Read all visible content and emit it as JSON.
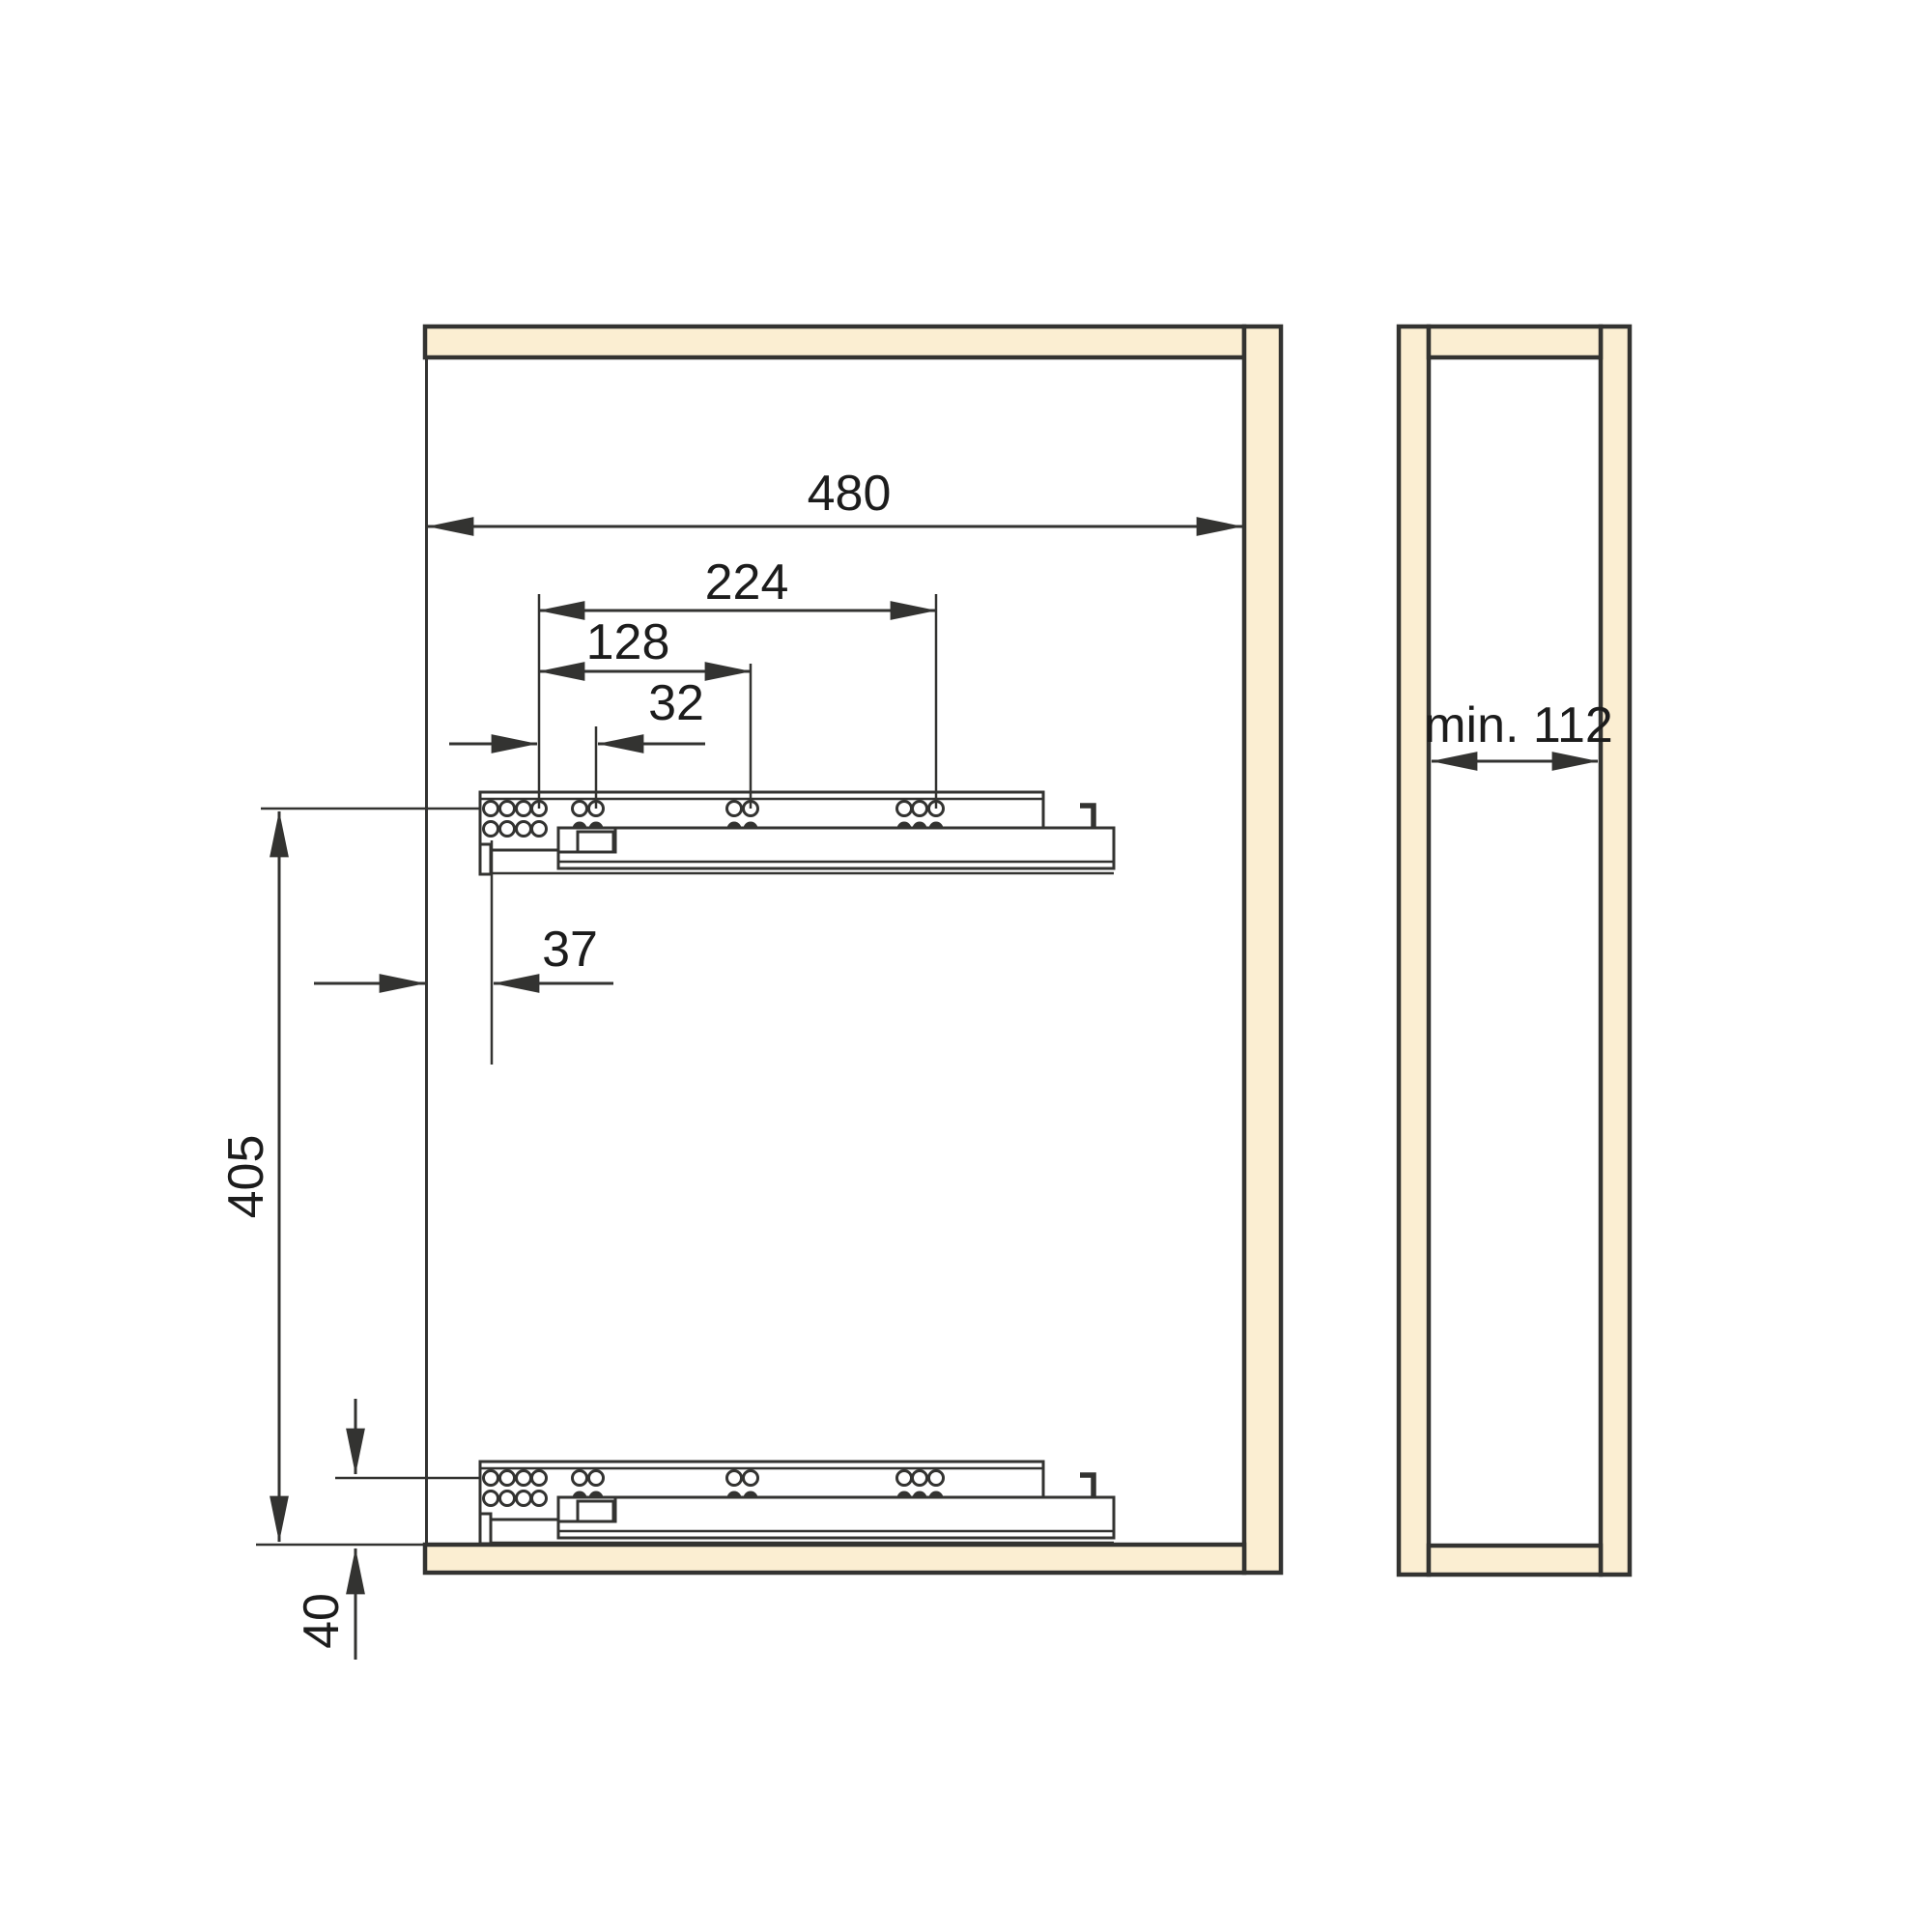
{
  "title": "Drawer runner installation drawing",
  "dimensions": {
    "overall_480": "480",
    "span_224": "224",
    "span_128": "128",
    "pitch_32": "32",
    "front_offset_37": "37",
    "runner_spacing_405": "405",
    "bottom_offset_40": "40",
    "side_min_width": "min. 112"
  },
  "colors": {
    "panel_fill": "#fbeed2",
    "line": "#333331",
    "text_color": "#1c1c1c"
  }
}
